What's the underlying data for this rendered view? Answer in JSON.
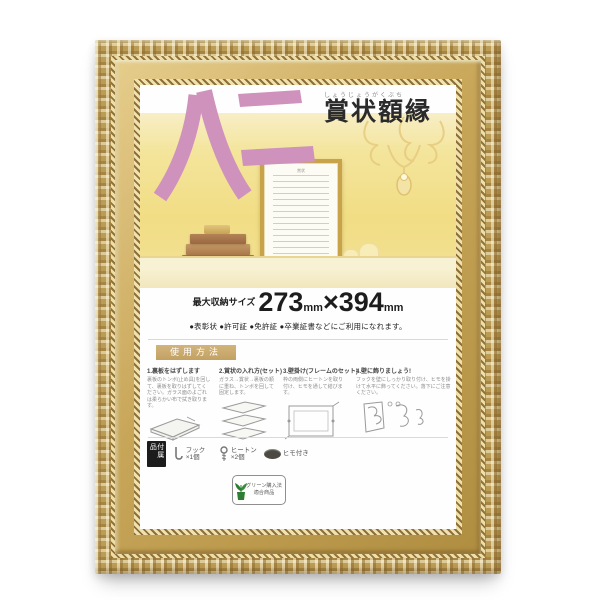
{
  "product": {
    "type_label": "賞状額縁",
    "type_label_furigana": "しょうじょうがくぶち",
    "size_name": "八二",
    "accent_pink": "#cf92bc",
    "frame_gold": "#c0a055"
  },
  "size_banner": {
    "prefix": "最大収納サイズ",
    "width_value": "273",
    "unit1": "mm",
    "times": "×",
    "height_value": "394",
    "unit2": "mm",
    "uses": "●表彰状 ●許可証 ●免許証 ●卒業証書などにご利用になれます。"
  },
  "instructions": {
    "header": "使用方法",
    "steps": [
      {
        "title": "1.裏板をはずします",
        "body": "裏板のトンボ(止め具)を回して、裏板を取りはずしてください。ガラス面のよごれは柔らかい布で拭き取ります。"
      },
      {
        "title": "2.賞状の入れ方(セット)",
        "body": "ガラス→賞状→裏板の順に重ね、トンボを回して固定します。"
      },
      {
        "title": "3.壁掛け(フレームのセット)",
        "body": "枠の両側にヒートンを取り付け、ヒモを通して結びます。"
      },
      {
        "title": "4.壁に飾りましょう!",
        "body": "フックを壁にしっかり取り付け、ヒモを掛けて水平に飾ってください。落下にご注意ください。"
      }
    ]
  },
  "accessories": {
    "header": "付属品",
    "items": [
      {
        "label": "フック ×1個"
      },
      {
        "label": "ヒートン ×2個"
      },
      {
        "label": "ヒモ付き"
      }
    ]
  },
  "green_mark": {
    "line1": "グリーン購入法",
    "line2": "適合商品"
  },
  "photo": {
    "certificate_caption": "賞状"
  }
}
